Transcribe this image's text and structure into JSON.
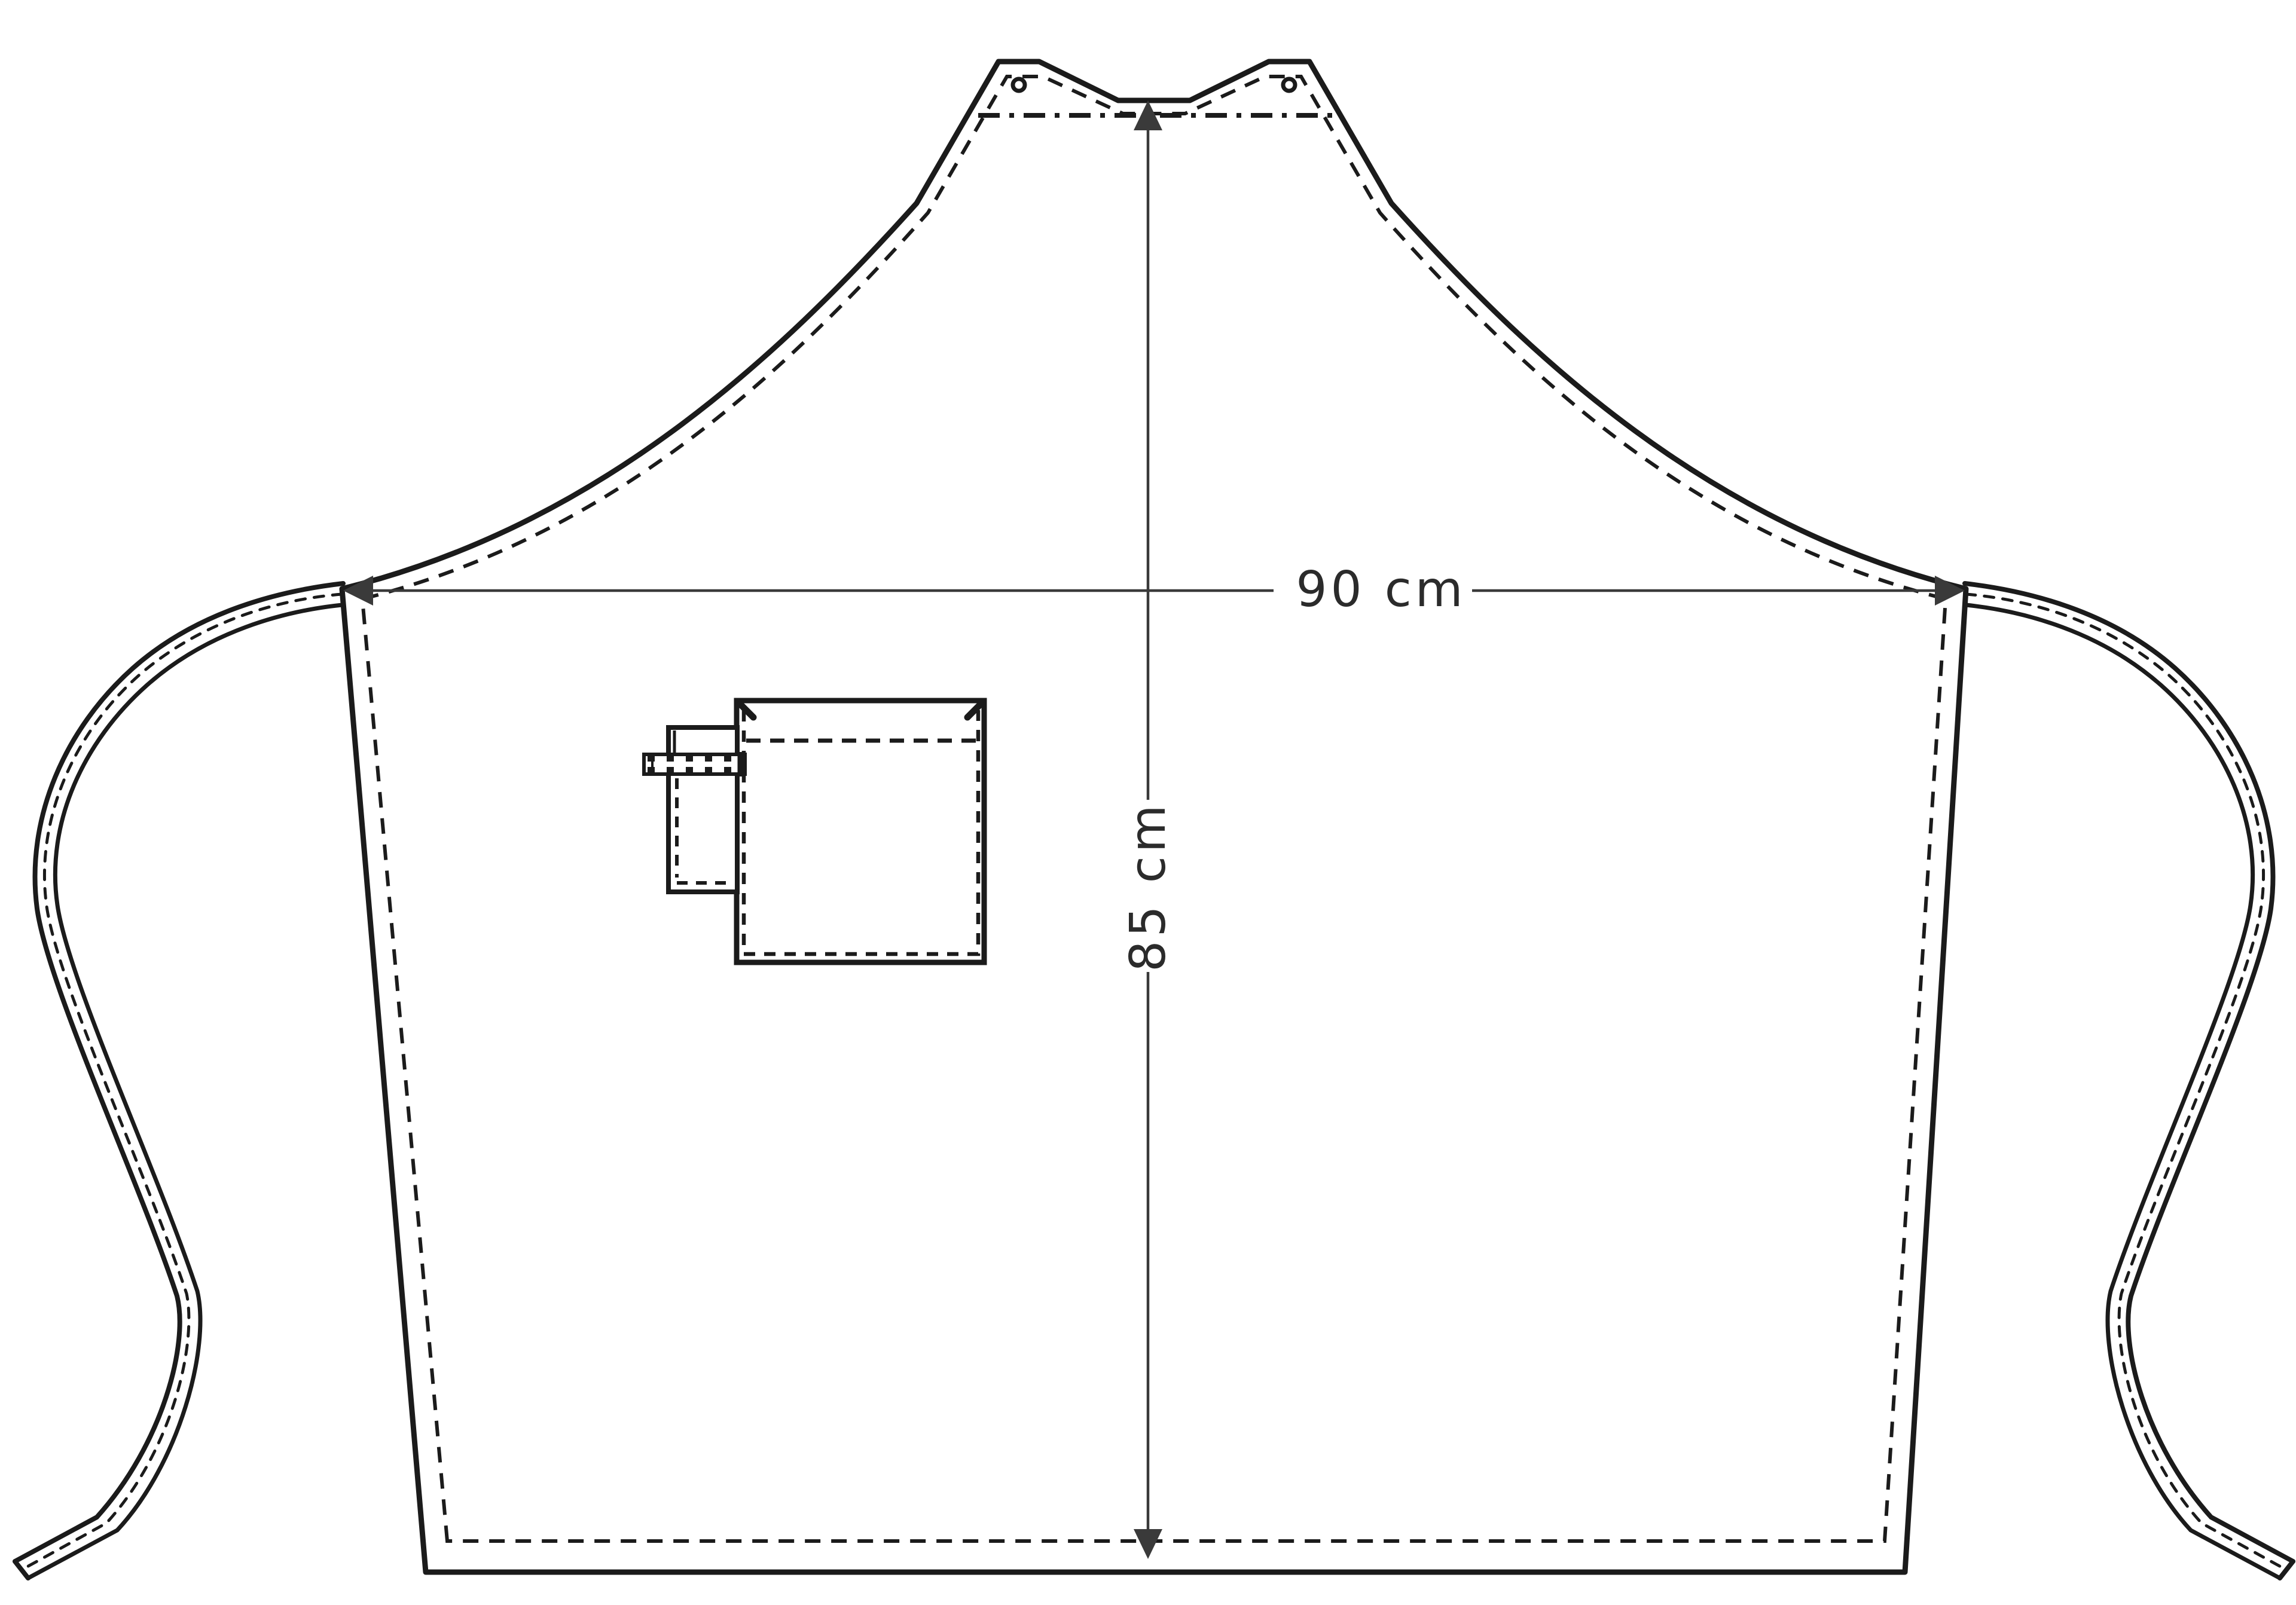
{
  "diagram": {
    "kind": "apron technical drawing",
    "width_dimension_label": "90 cm",
    "height_dimension_label": "85 cm"
  },
  "style": {
    "line_color": "#1b1b1b",
    "dimension_color": "#3a3a3a",
    "label_color": "#2b2b2b",
    "background_color": "#ffffff"
  }
}
